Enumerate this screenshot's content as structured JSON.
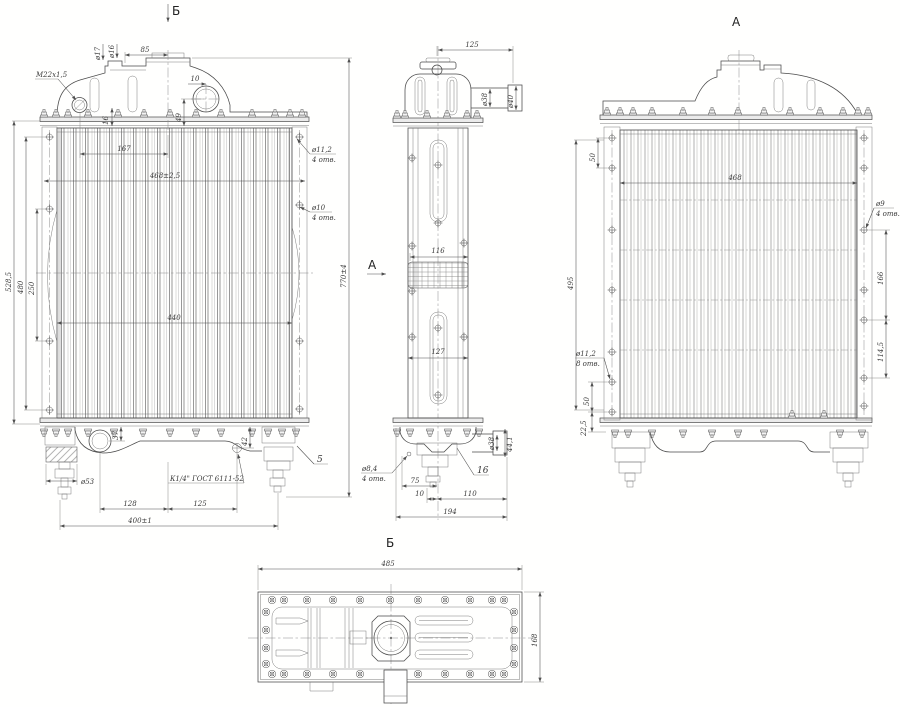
{
  "meta": {
    "background": "#ffffff",
    "ink": "#4a4a4a",
    "thin_ink": "#7d7d7d"
  },
  "view_markers": {
    "top": "Б",
    "side": "А"
  },
  "view_titles": {
    "rear": "А",
    "bottom": "Б"
  },
  "front": {
    "m22": "М22х1,5",
    "d17": "ø17",
    "d16": "ø16",
    "l85": "85",
    "l10": "10",
    "l49": "49",
    "l16": "16",
    "l167": "167",
    "l468": "468±2,5",
    "l440": "440",
    "l5285": "528,5",
    "l480": "480",
    "l250": "250",
    "d112": "ø11,2",
    "d112q": "4 отв.",
    "d10": "ø10",
    "d10q": "4 отв.",
    "l770": "770±4",
    "d53": "ø53",
    "l37": "37",
    "l42": "42",
    "l128": "128",
    "l125": "125",
    "l400": "400±1",
    "k14": "К1/4\" ГОСТ 6111-52",
    "item5": "5"
  },
  "side": {
    "l125": "125",
    "d38t": "ø38",
    "d40t": "ø40",
    "l116": "116",
    "l127": "127",
    "d84": "ø8,4",
    "d84q": "4 отв.",
    "l75": "75",
    "l10": "10",
    "l110": "110",
    "l194": "194",
    "item16": "16",
    "d38b": "ø38",
    "l441": "44,1"
  },
  "rear": {
    "l50t": "50",
    "l495": "495",
    "l468": "468",
    "d9": "ø9",
    "d9q": "4 отв.",
    "l166": "166",
    "l1145": "114,5",
    "d112": "ø11,2",
    "d112q": "8 отв.",
    "l50b": "50",
    "l225": "22,5"
  },
  "bottom": {
    "l485": "485",
    "l168": "168"
  }
}
